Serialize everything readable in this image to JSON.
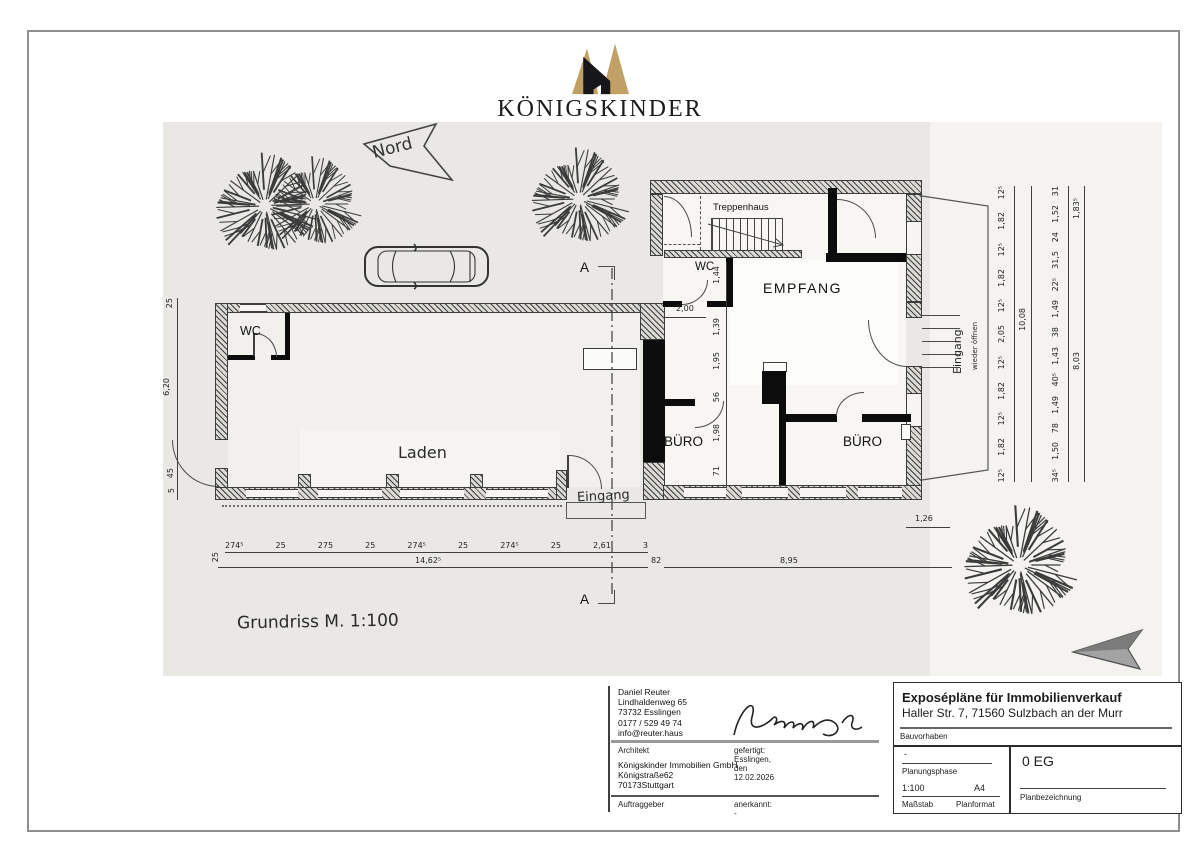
{
  "logo": {
    "brand": "KÖNIGSKINDER",
    "subtitle": "IMMOBILIEN",
    "gold": "#c0a065",
    "dark": "#1b1b1e"
  },
  "plan": {
    "north_label": "Nord",
    "scale_label": "Grundriss M. 1:100",
    "section_marker": "A",
    "rooms": {
      "treppenhaus": "Treppenhaus",
      "wc_right": "WC",
      "empfang": "EMPFANG",
      "buero_left": "BÜRO",
      "buero_right": "BÜRO",
      "wc_left": "WC",
      "laden": "Laden",
      "eingang_laden": "Eingang",
      "eingang_right": "Eingang",
      "eingang_right_note": "wieder öffnen"
    },
    "dims": {
      "left_chain": [
        "25",
        "6,20",
        "45",
        "5"
      ],
      "middle_chain": [
        "1,44",
        "1,39",
        "1,95",
        "56",
        "1,98",
        "71"
      ],
      "empfang_width": "2,00",
      "bottom_segments": [
        "274⁵",
        "25",
        "275",
        "25",
        "274⁵",
        "25",
        "274⁵",
        "25",
        "2,61",
        "3"
      ],
      "bottom_left_tick": "25",
      "bottom_total": "14,62⁵",
      "bottom_right_small": "82",
      "site_width": "8,95",
      "step_width": "1,26",
      "right_inner_chain": [
        "12⁵",
        "1,82",
        "12⁵",
        "1,82",
        "12⁵",
        "2,05",
        "12⁵",
        "1,82",
        "12⁵",
        "1,82",
        "12⁵"
      ],
      "right_inner_total": "10,08",
      "right_outer_chain": [
        "31",
        "1,52",
        "24",
        "31,5",
        "22⁵",
        "1,49",
        "38",
        "1,43",
        "40⁵",
        "1,49",
        "78",
        "1,50",
        "34⁵"
      ],
      "right_outer_total_top": "1,83⁵",
      "right_outer_total": "8,03"
    }
  },
  "titleblock": {
    "architect": {
      "lines": [
        "Daniel Reuter",
        "Lindhaldenweg 65",
        "73732 Esslingen",
        "0177 / 529 49 74",
        "info@reuter.haus"
      ],
      "role_label": "Architekt",
      "made_label": "gefertigt: Esslingen, den 12.02.2026"
    },
    "client": {
      "lines": [
        "Königskinder Immobilien GmbH",
        "Königstraße62",
        "70173Stuttgart"
      ],
      "role_label": "Auftraggeber",
      "approved_label": "anerkannt: -"
    },
    "project": {
      "title": "Exposépläne für Immobilienverkauf",
      "address": "Haller Str. 7, 71560 Sulzbach an der Murr",
      "label": "Bauvorhaben"
    },
    "phase": {
      "value": "-",
      "label": "Planungsphase"
    },
    "scale": {
      "value": "1:100",
      "label": "Maßstab"
    },
    "format": {
      "value": "A4",
      "label": "Planformat"
    },
    "plan_name": {
      "value": "0 EG",
      "label": "Planbezeichnung"
    }
  }
}
